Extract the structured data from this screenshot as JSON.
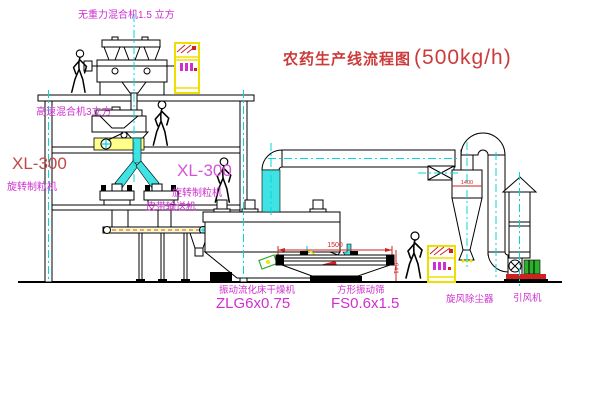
{
  "title": {
    "main": "农药生产线流程图",
    "capacity": "(500kg/h)"
  },
  "labels": {
    "gravity_free_mixer": "无重力混合机1.5 立方",
    "high_speed_mixer": "高速混合机3立方",
    "granulator_left": {
      "model": "XL-300",
      "name": "旋转制粒机"
    },
    "granulator_mid": {
      "model": "XL-300",
      "name": "旋转制粒机"
    },
    "belt_conveyor": "皮带输送机",
    "fluid_bed_dryer": {
      "name": "振动流化床干燥机",
      "model": "ZLG6x0.75"
    },
    "vibrating_screen": {
      "name": "方形振动筛",
      "model": "FS0.6x1.5"
    },
    "cyclone_dust_collector": "旋风除尘器",
    "induced_draft_fan": "引风机"
  },
  "dimensions": {
    "screen_length": "1500",
    "screen_height": "941",
    "cyclone_dia": "1400"
  },
  "colors": {
    "title_red": "#cc3b3b",
    "label_magenta": "#cf2fcf",
    "centerline_cyan": "#00d8d8",
    "pipe_cyan": "#3fe3e3",
    "cabinet_yellow": "#efdf00",
    "dimension_red": "#d02020",
    "motor_green": "#2db02d",
    "bg": "#ffffff"
  }
}
